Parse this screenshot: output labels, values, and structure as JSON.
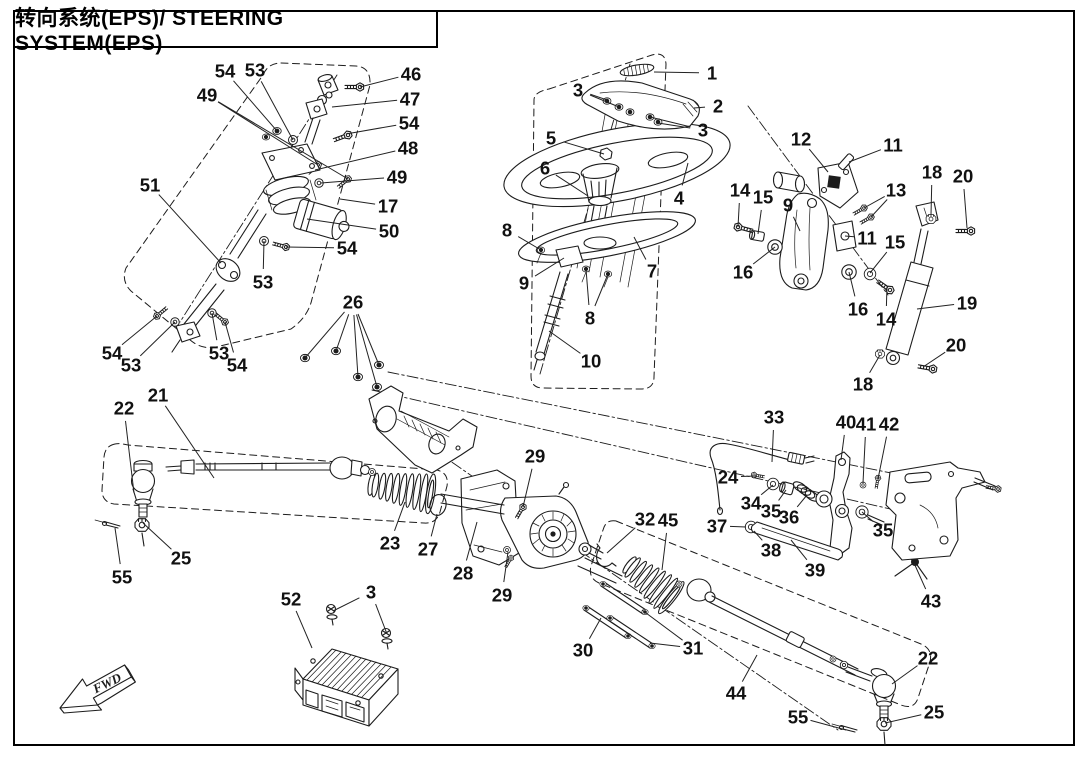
{
  "title": "转向系统(EPS)/ STEERING SYSTEM(EPS)",
  "fwd": "FWD",
  "callouts": [
    {
      "n": "54",
      "x": 225,
      "y": 71,
      "t": [
        [
          277,
          131
        ]
      ]
    },
    {
      "n": "53",
      "x": 255,
      "y": 70,
      "t": [
        [
          293,
          140
        ]
      ]
    },
    {
      "n": "49",
      "x": 207,
      "y": 95,
      "t": [
        [
          318,
          165
        ],
        [
          348,
          179
        ]
      ]
    },
    {
      "n": "46",
      "x": 411,
      "y": 74,
      "t": [
        [
          360,
          87
        ]
      ]
    },
    {
      "n": "47",
      "x": 410,
      "y": 99,
      "t": [
        [
          332,
          107
        ]
      ]
    },
    {
      "n": "54",
      "x": 409,
      "y": 123,
      "t": [
        [
          346,
          134
        ]
      ]
    },
    {
      "n": "48",
      "x": 408,
      "y": 148,
      "t": [
        [
          315,
          170
        ]
      ]
    },
    {
      "n": "49",
      "x": 397,
      "y": 177,
      "t": [
        [
          321,
          183
        ]
      ]
    },
    {
      "n": "17",
      "x": 388,
      "y": 206,
      "t": [
        [
          340,
          199
        ]
      ]
    },
    {
      "n": "50",
      "x": 389,
      "y": 231,
      "t": [
        [
          307,
          219
        ]
      ]
    },
    {
      "n": "51",
      "x": 150,
      "y": 185,
      "t": [
        [
          221,
          263
        ]
      ]
    },
    {
      "n": "54",
      "x": 347,
      "y": 248,
      "t": [
        [
          286,
          247
        ]
      ]
    },
    {
      "n": "53",
      "x": 263,
      "y": 282,
      "t": [
        [
          264,
          241
        ]
      ]
    },
    {
      "n": "54",
      "x": 112,
      "y": 353,
      "t": [
        [
          157,
          316
        ]
      ]
    },
    {
      "n": "53",
      "x": 131,
      "y": 365,
      "t": [
        [
          175,
          322
        ]
      ]
    },
    {
      "n": "53",
      "x": 219,
      "y": 353,
      "t": [
        [
          212,
          313
        ]
      ]
    },
    {
      "n": "54",
      "x": 237,
      "y": 365,
      "t": [
        [
          225,
          322
        ]
      ]
    },
    {
      "n": "1",
      "x": 712,
      "y": 73,
      "t": [
        [
          654,
          72
        ]
      ]
    },
    {
      "n": "2",
      "x": 718,
      "y": 106,
      "t": [
        [
          694,
          108
        ]
      ]
    },
    {
      "n": "3",
      "x": 578,
      "y": 90,
      "t": [
        [
          607,
          100
        ],
        [
          619,
          107
        ]
      ]
    },
    {
      "n": "3",
      "x": 703,
      "y": 130,
      "t": [
        [
          650,
          117
        ],
        [
          658,
          123
        ]
      ]
    },
    {
      "n": "5",
      "x": 551,
      "y": 138,
      "t": [
        [
          604,
          154
        ]
      ]
    },
    {
      "n": "6",
      "x": 545,
      "y": 168,
      "t": [
        [
          588,
          196
        ]
      ]
    },
    {
      "n": "4",
      "x": 679,
      "y": 198,
      "t": [
        [
          688,
          163
        ]
      ]
    },
    {
      "n": "8",
      "x": 507,
      "y": 230,
      "t": [
        [
          541,
          250
        ]
      ]
    },
    {
      "n": "9",
      "x": 524,
      "y": 283,
      "t": [
        [
          564,
          258
        ]
      ]
    },
    {
      "n": "7",
      "x": 652,
      "y": 271,
      "t": [
        [
          634,
          237
        ]
      ]
    },
    {
      "n": "8",
      "x": 590,
      "y": 318,
      "t": [
        [
          586,
          269
        ],
        [
          608,
          274
        ]
      ]
    },
    {
      "n": "10",
      "x": 591,
      "y": 361,
      "t": [
        [
          549,
          331
        ]
      ]
    },
    {
      "n": "12",
      "x": 801,
      "y": 139,
      "t": [
        [
          828,
          172
        ]
      ]
    },
    {
      "n": "11",
      "x": 893,
      "y": 145,
      "t": [
        [
          849,
          162
        ]
      ]
    },
    {
      "n": "13",
      "x": 896,
      "y": 190,
      "t": [
        [
          864,
          208
        ],
        [
          871,
          217
        ]
      ]
    },
    {
      "n": "18",
      "x": 932,
      "y": 172,
      "t": [
        [
          931,
          215
        ]
      ]
    },
    {
      "n": "20",
      "x": 963,
      "y": 176,
      "t": [
        [
          967,
          228
        ]
      ]
    },
    {
      "n": "14",
      "x": 740,
      "y": 190,
      "t": [
        [
          738,
          227
        ]
      ]
    },
    {
      "n": "15",
      "x": 763,
      "y": 197,
      "t": [
        [
          758,
          234
        ]
      ]
    },
    {
      "n": "9",
      "x": 788,
      "y": 205,
      "t": [
        [
          800,
          231
        ]
      ]
    },
    {
      "n": "11",
      "x": 867,
      "y": 238,
      "t": [
        [
          845,
          236
        ]
      ]
    },
    {
      "n": "15",
      "x": 895,
      "y": 242,
      "t": [
        [
          870,
          273
        ]
      ]
    },
    {
      "n": "16",
      "x": 743,
      "y": 272,
      "t": [
        [
          775,
          247
        ]
      ]
    },
    {
      "n": "16",
      "x": 858,
      "y": 309,
      "t": [
        [
          849,
          272
        ]
      ]
    },
    {
      "n": "14",
      "x": 886,
      "y": 319,
      "t": [
        [
          887,
          286
        ]
      ]
    },
    {
      "n": "19",
      "x": 967,
      "y": 303,
      "t": [
        [
          917,
          309
        ]
      ]
    },
    {
      "n": "20",
      "x": 956,
      "y": 345,
      "t": [
        [
          923,
          367
        ]
      ]
    },
    {
      "n": "18",
      "x": 863,
      "y": 384,
      "t": [
        [
          880,
          355
        ]
      ]
    },
    {
      "n": "26",
      "x": 353,
      "y": 302,
      "t": [
        [
          305,
          358
        ],
        [
          336,
          351
        ],
        [
          358,
          377
        ],
        [
          379,
          365
        ],
        [
          377,
          387
        ]
      ]
    },
    {
      "n": "21",
      "x": 158,
      "y": 395,
      "t": [
        [
          214,
          478
        ]
      ]
    },
    {
      "n": "22",
      "x": 124,
      "y": 408,
      "t": [
        [
          134,
          493
        ]
      ]
    },
    {
      "n": "25",
      "x": 181,
      "y": 558,
      "t": [
        [
          143,
          523
        ]
      ]
    },
    {
      "n": "55",
      "x": 122,
      "y": 577,
      "t": [
        [
          115,
          528
        ]
      ]
    },
    {
      "n": "23",
      "x": 390,
      "y": 543,
      "t": [
        [
          405,
          502
        ]
      ]
    },
    {
      "n": "27",
      "x": 428,
      "y": 549,
      "t": [
        [
          437,
          514
        ]
      ]
    },
    {
      "n": "28",
      "x": 463,
      "y": 573,
      "t": [
        [
          477,
          522
        ]
      ]
    },
    {
      "n": "29",
      "x": 535,
      "y": 456,
      "t": [
        [
          523,
          507
        ]
      ]
    },
    {
      "n": "29",
      "x": 502,
      "y": 595,
      "t": [
        [
          508,
          552
        ]
      ]
    },
    {
      "n": "32",
      "x": 645,
      "y": 519,
      "t": [
        [
          607,
          553
        ]
      ]
    },
    {
      "n": "45",
      "x": 668,
      "y": 520,
      "t": [
        [
          662,
          570
        ]
      ]
    },
    {
      "n": "30",
      "x": 583,
      "y": 650,
      "t": [
        [
          601,
          618
        ]
      ]
    },
    {
      "n": "31",
      "x": 693,
      "y": 648,
      "t": [
        [
          642,
          610
        ],
        [
          650,
          643
        ]
      ]
    },
    {
      "n": "33",
      "x": 774,
      "y": 417,
      "t": [
        [
          772,
          462
        ]
      ]
    },
    {
      "n": "40",
      "x": 846,
      "y": 422,
      "t": [
        [
          841,
          460
        ]
      ]
    },
    {
      "n": "41",
      "x": 866,
      "y": 424,
      "t": [
        [
          863,
          483
        ]
      ]
    },
    {
      "n": "42",
      "x": 889,
      "y": 424,
      "t": [
        [
          878,
          479
        ]
      ]
    },
    {
      "n": "24",
      "x": 728,
      "y": 477,
      "t": [
        [
          756,
          476
        ]
      ]
    },
    {
      "n": "34",
      "x": 751,
      "y": 503,
      "t": [
        [
          773,
          485
        ]
      ]
    },
    {
      "n": "35",
      "x": 771,
      "y": 511,
      "t": [
        [
          786,
          490
        ]
      ]
    },
    {
      "n": "36",
      "x": 789,
      "y": 517,
      "t": [
        [
          807,
          495
        ]
      ]
    },
    {
      "n": "37",
      "x": 717,
      "y": 526,
      "t": [
        [
          746,
          527
        ]
      ]
    },
    {
      "n": "38",
      "x": 771,
      "y": 550,
      "t": [
        [
          754,
          531
        ]
      ]
    },
    {
      "n": "39",
      "x": 815,
      "y": 570,
      "t": [
        [
          791,
          540
        ]
      ]
    },
    {
      "n": "35",
      "x": 883,
      "y": 530,
      "t": [
        [
          862,
          512
        ]
      ]
    },
    {
      "n": "43",
      "x": 931,
      "y": 601,
      "t": [
        [
          914,
          563
        ]
      ]
    },
    {
      "n": "52",
      "x": 291,
      "y": 599,
      "t": [
        [
          312,
          648
        ]
      ]
    },
    {
      "n": "3",
      "x": 371,
      "y": 592,
      "t": [
        [
          333,
          611
        ],
        [
          387,
          634
        ]
      ]
    },
    {
      "n": "44",
      "x": 736,
      "y": 693,
      "t": [
        [
          757,
          655
        ]
      ]
    },
    {
      "n": "22",
      "x": 928,
      "y": 658,
      "t": [
        [
          892,
          684
        ]
      ]
    },
    {
      "n": "25",
      "x": 934,
      "y": 712,
      "t": [
        [
          885,
          723
        ]
      ]
    },
    {
      "n": "55",
      "x": 798,
      "y": 717,
      "t": [
        [
          846,
          730
        ]
      ]
    }
  ]
}
